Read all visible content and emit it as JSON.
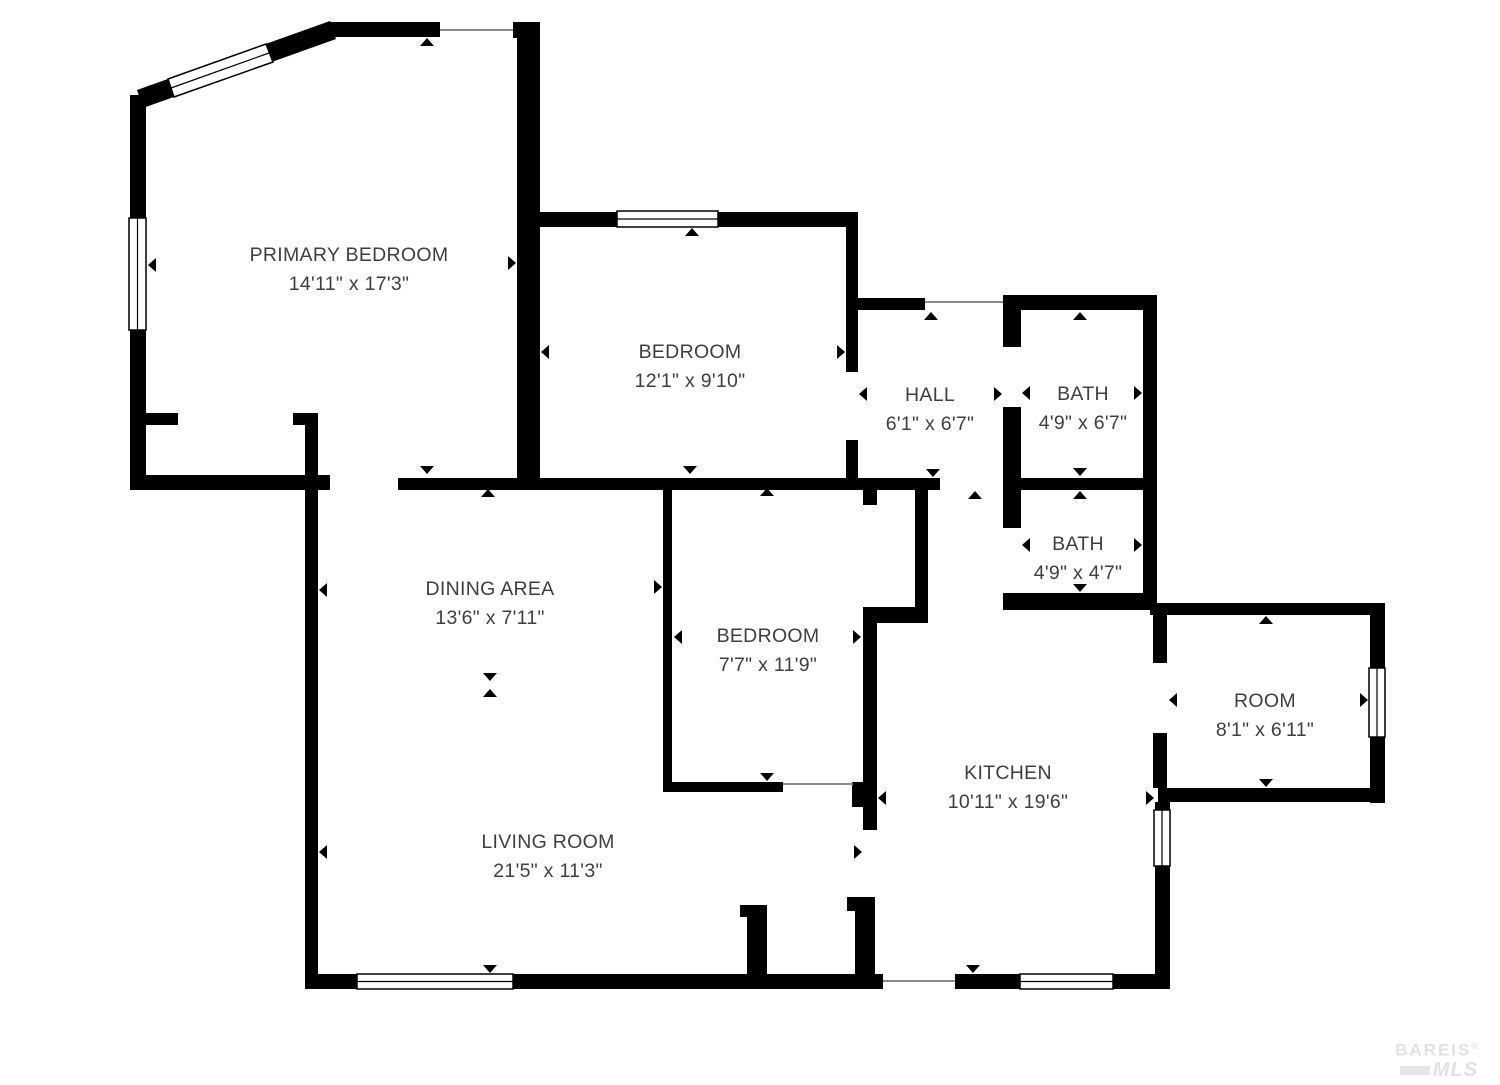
{
  "floorplan": {
    "rooms": [
      {
        "name": "PRIMARY BEDROOM",
        "dims": "14'11\" x 17'3\""
      },
      {
        "name": "BEDROOM",
        "dims": "12'1\" x 9'10\""
      },
      {
        "name": "HALL",
        "dims": "6'1\" x 6'7\""
      },
      {
        "name": "BATH",
        "dims": "4'9\" x 6'7\""
      },
      {
        "name": "BATH",
        "dims": "4'9\" x 4'7\""
      },
      {
        "name": "DINING AREA",
        "dims": "13'6\" x 7'11\""
      },
      {
        "name": "BEDROOM",
        "dims": "7'7\" x 11'9\""
      },
      {
        "name": "ROOM",
        "dims": "8'1\" x 6'11\""
      },
      {
        "name": "KITCHEN",
        "dims": "10'11\" x 19'6\""
      },
      {
        "name": "LIVING ROOM",
        "dims": "21'5\" x 11'3\""
      }
    ],
    "colors": {
      "wall": "#000000",
      "label_text": "#3f3f3f",
      "threshold_line": "#8a8a8a",
      "watermark": "#e2e2e2"
    },
    "watermark": {
      "brand": "BAREIS",
      "registered": "®",
      "sub": "MLS"
    }
  }
}
